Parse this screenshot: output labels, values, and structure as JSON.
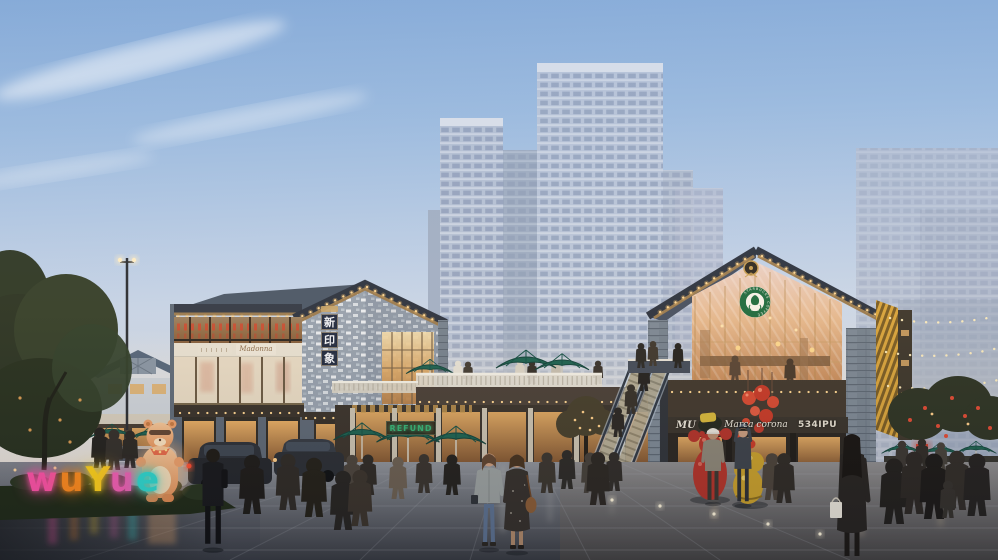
{
  "signs": {
    "wuyue_neon": {
      "word": "wuYue",
      "letters": [
        {
          "char": "w",
          "color": "#ff52a8"
        },
        {
          "char": "u",
          "color": "#ff8a1e"
        },
        {
          "char": "Y",
          "color": "#ffd21a"
        },
        {
          "char": "u",
          "color": "#f45fb5"
        },
        {
          "char": "e",
          "color": "#2ed8d0"
        }
      ]
    },
    "gable_banner": {
      "chars": [
        "新",
        "印",
        "象"
      ]
    },
    "boutique_script": "Madonna",
    "green_storefront": "REFUND",
    "right_sign_band": {
      "left": "MU",
      "center": "Marca corona",
      "right": "534IPU"
    },
    "coffee_logo_ring": "STARBUCKS COFFEE"
  },
  "colors": {
    "sky_top": "#86abd8",
    "sky_horizon": "#eae1d6",
    "tower": "#b9c5d8",
    "roof": "#2c3340",
    "timber": "#9a7b50",
    "umbrella_canopy": "#1d6352",
    "lantern_red": "#d84a32",
    "mascot_glow": "#ffb46e",
    "warm_interior": "#e8b068",
    "coffee_green": "#1e6b3f",
    "pavement": "#53565e"
  }
}
